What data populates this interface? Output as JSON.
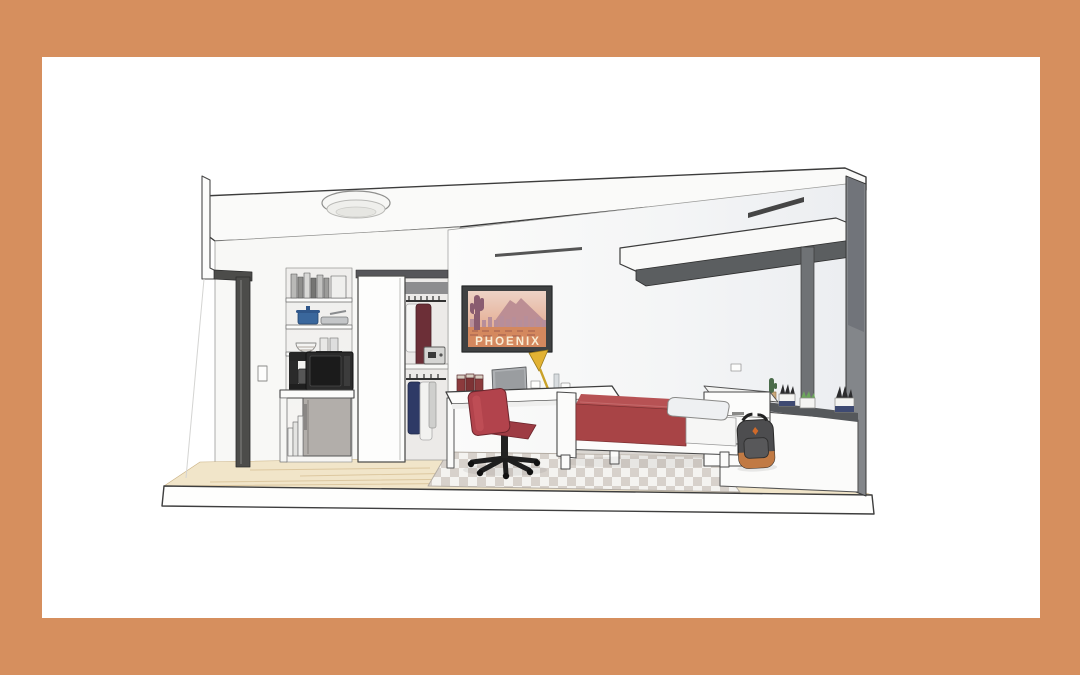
{
  "scene": {
    "kind": "architectural-cutaway-room-render",
    "description": "Cutaway 3D rendering of a furnished studio dorm room with kitchenette, closet, desk and bed",
    "poster": {
      "caption": "PHOENIX"
    },
    "palette": {
      "mat_border": "#d68f5e",
      "canvas_white": "#ffffff",
      "outline": "#3c3c3c",
      "wall_white": "#fafaf9",
      "wall_shade": "#eef0f3",
      "wood_floor": "#f1e5c9",
      "wood_line": "#dcc79f",
      "rug_gray": "#d7d1cb",
      "rug_white": "#f4f3f0",
      "bed_blanket": "#a84446",
      "bed_blanket_top": "#b75254",
      "desk_chair": "#b2434c",
      "chair_seat": "#9e3c44",
      "lamp_yellow": "#e2b233",
      "backpack_gray": "#4d4d4f",
      "backpack_accent": "#c17a44",
      "coat_maroon": "#6c2f37",
      "shirt_navy": "#2e3a66",
      "pot_blue": "#3a679c",
      "appliance_black": "#2b2b2b",
      "fridge_gray": "#b2aeaa",
      "door_frame_gray": "#4c4c4a",
      "window_gray": "#6f7275",
      "shade_housing_gray": "#5b5e60",
      "ledge_gray": "#55585b",
      "poster_frame": "#3f4142",
      "poster_sky_top": "#edd3c6",
      "poster_sky_bottom": "#dfa183",
      "poster_mountain": "#bc8e94",
      "poster_ground": "#d4885e",
      "poster_text": "#f8ecd4"
    },
    "objects": [
      "ceiling-light",
      "entry-door-frame",
      "light-switch",
      "kitchen-shelves",
      "shelf-books",
      "blue-pot",
      "frying-pan",
      "bowl-and-cups",
      "coffee-maker",
      "microwave",
      "kitchen-counter",
      "mini-fridge",
      "leaning-books",
      "closet-sliding-door",
      "hangers",
      "hanging-clothes",
      "safe",
      "phoenix-poster",
      "desk",
      "desk-canisters",
      "laptop",
      "desk-lamp",
      "wall-outlet",
      "office-chair",
      "bed",
      "pillow",
      "storage-headboard",
      "backpack",
      "window-mullion",
      "roller-shade",
      "air-vent-slot",
      "window-ledge",
      "potted-plants",
      "checkered-rug",
      "wood-floor",
      "floor-slab"
    ]
  }
}
